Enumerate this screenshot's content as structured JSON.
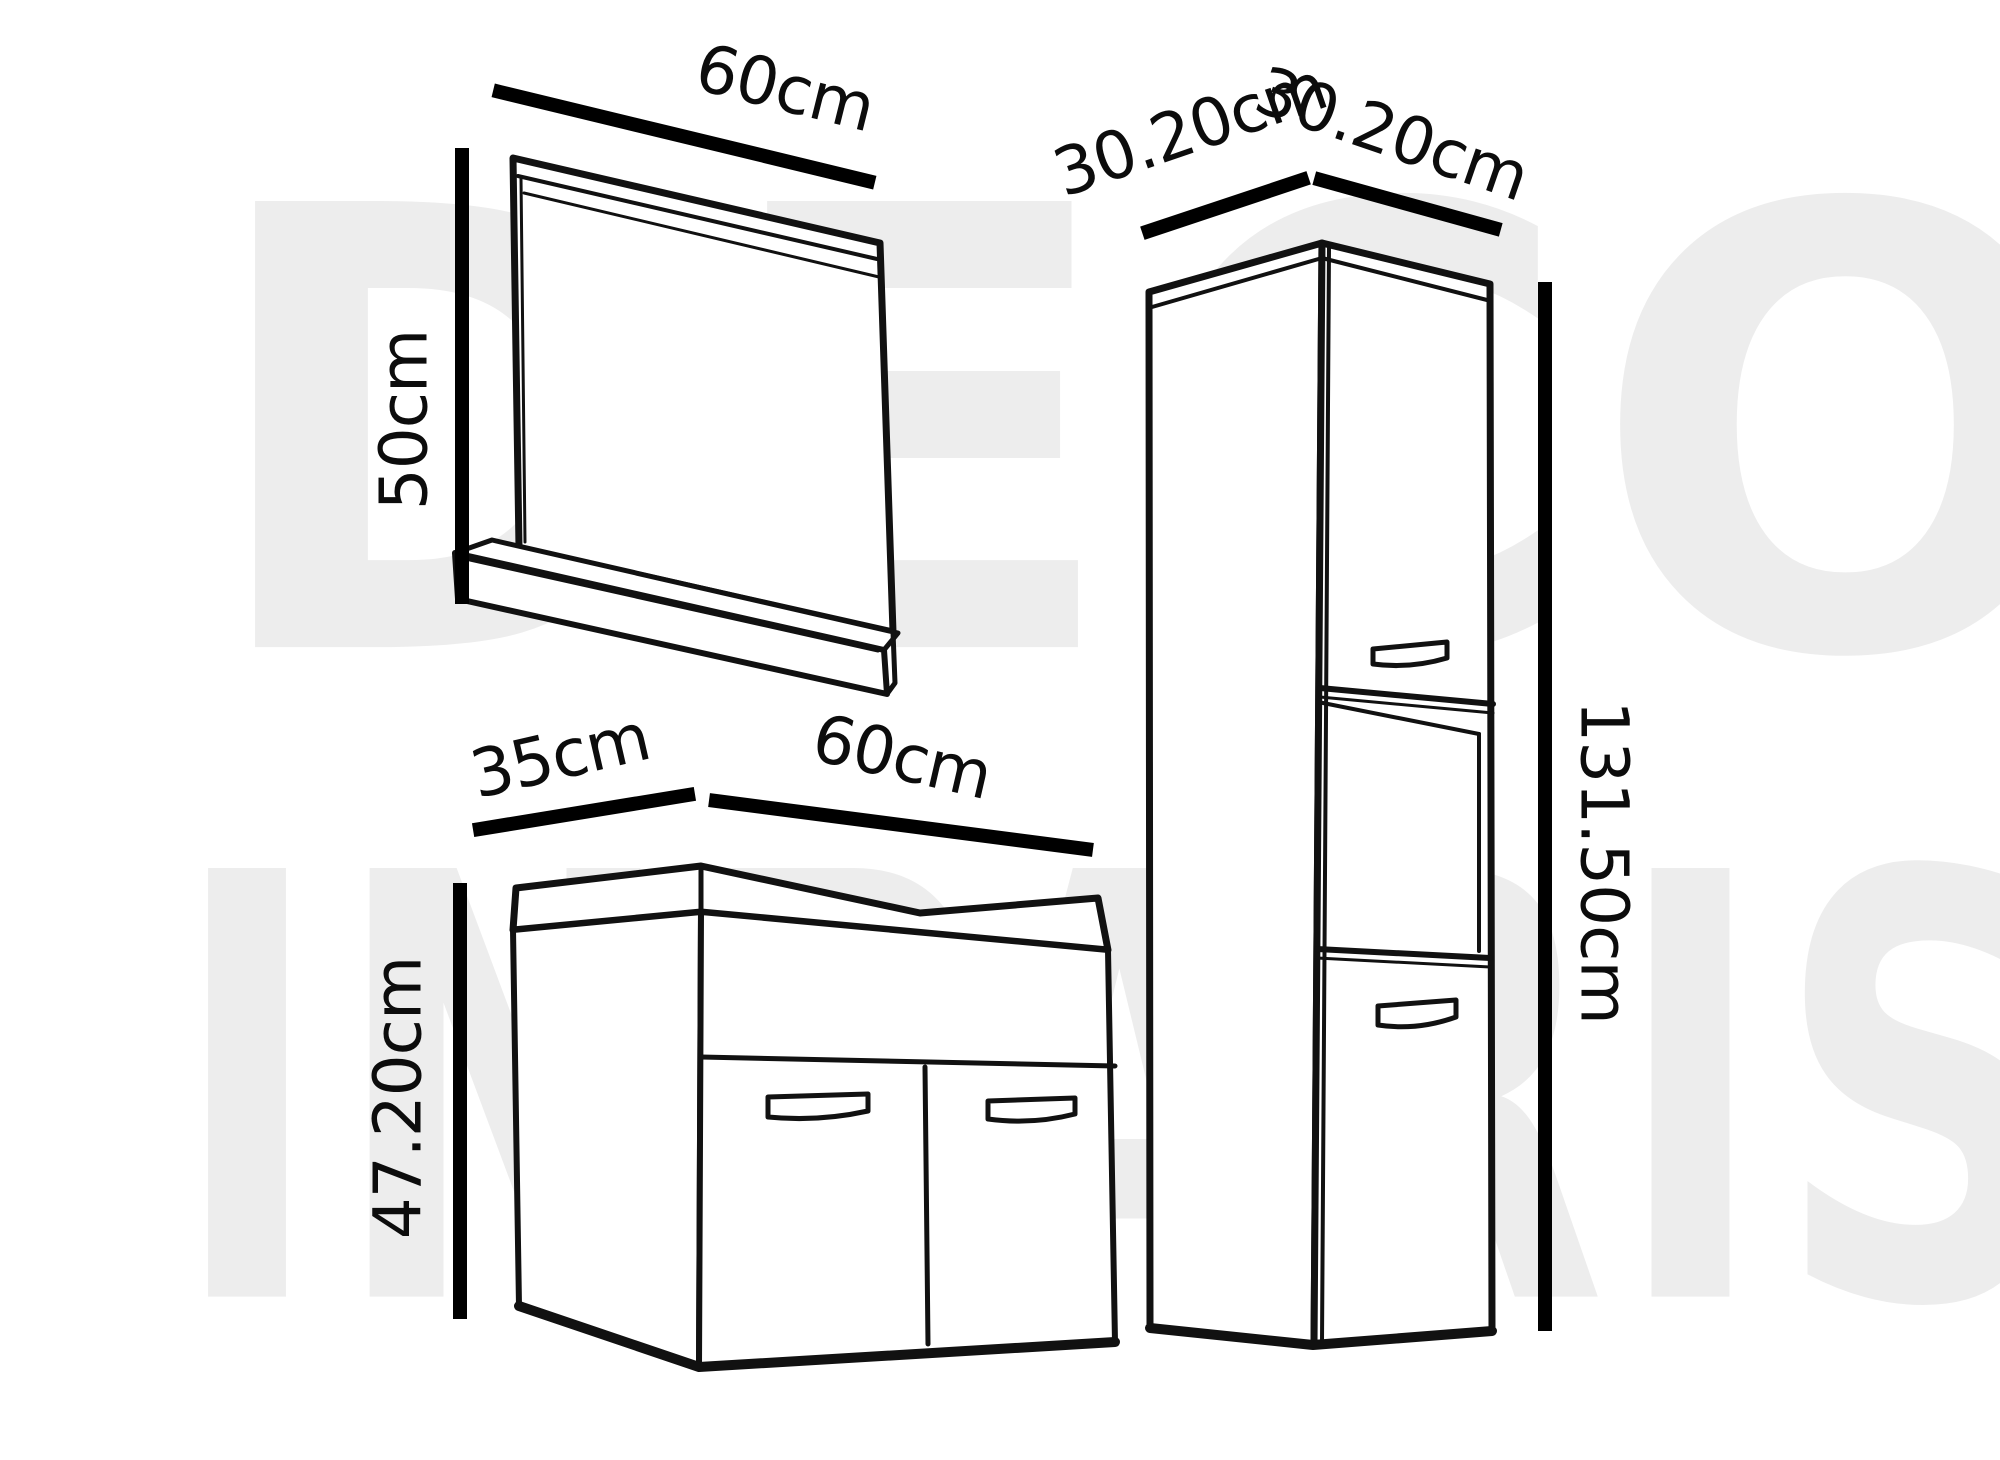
{
  "figure": {
    "type": "furniture-dimension-diagram",
    "items": [
      "mirror-with-shelf",
      "vanity-two-door-cabinet",
      "tall-column-cabinet"
    ]
  },
  "labels": {
    "mirror_width": "60cm",
    "mirror_height": "50cm",
    "vanity_depth": "35cm",
    "vanity_width": "60cm",
    "vanity_height": "47.20cm",
    "cabinet_depth": "30.20cm",
    "cabinet_width": "30.20cm",
    "cabinet_height": "131.50cm"
  },
  "watermark": {
    "line1": "DECO",
    "line2": "INPARIS"
  },
  "colors": {
    "background": "#ffffff",
    "line_art": "#111111",
    "dimension_lines": "#000000",
    "watermark": "#ededed"
  }
}
